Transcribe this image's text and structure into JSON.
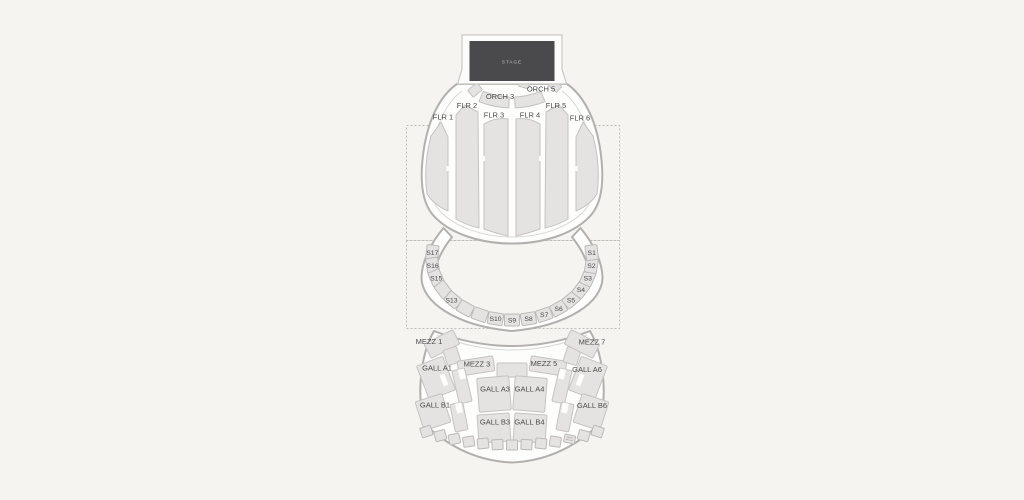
{
  "stage": {
    "label": "STAGE"
  },
  "colors": {
    "background": "#f5f4f1",
    "section_fill": "#e4e3e1",
    "section_stroke": "#c5c3c0",
    "outline_stroke": "#b1b0ad",
    "stage_fill": "#4a4a4c",
    "label_color": "#4b4b4b",
    "dashed_border": "#bdbcb9"
  },
  "floor": {
    "orch_3": "ORCH 3",
    "orch_5": "ORCH 5",
    "flr_1": "FLR 1",
    "flr_2": "FLR 2",
    "flr_3": "FLR 3",
    "flr_4": "FLR 4",
    "flr_5": "FLR 5",
    "flr_6": "FLR 6"
  },
  "ring": {
    "s17": "S17",
    "s16": "S16",
    "s15": "S15",
    "s13": "S13",
    "s10": "S10",
    "s9": "S9",
    "s8": "S8",
    "s7": "S7",
    "s6": "S6",
    "s5": "S5",
    "s4": "S4",
    "s3": "S3",
    "s2": "S2",
    "s1": "S1"
  },
  "balcony": {
    "mezz_1": "MEZZ 1",
    "mezz_3": "MEZZ 3",
    "mezz_5": "MEZZ 5",
    "mezz_7": "MEZZ 7",
    "gall_a1": "GALL A1",
    "gall_a3": "GALL A3",
    "gall_a4": "GALL A4",
    "gall_a6": "GALL A6",
    "gall_b1": "GALL B1",
    "gall_b3": "GALL B3",
    "gall_b4": "GALL B4",
    "gall_b6": "GALL B6"
  }
}
